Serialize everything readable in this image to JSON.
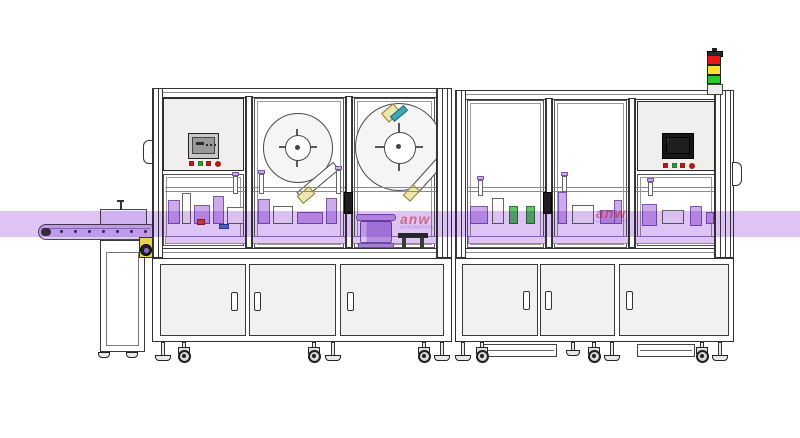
{
  "scene": {
    "watermark": {
      "text_main": "anw",
      "text_sub": "AUTOMATION"
    }
  },
  "colors": {
    "purple_band": "#c9a0ee",
    "machinery_lavender": "#cdaaec",
    "accent_yellow": "#e8d44a",
    "tower_red": "#e81818",
    "tower_yellow": "#ffe02e",
    "tower_green": "#2ec82e",
    "panel_gray": "#f0efee",
    "hmi_screen_left": "#989898",
    "hmi_screen_right": "#1f1f1f",
    "button_red": "#cc1111",
    "button_green": "#22aa22"
  },
  "tower": {
    "lights": [
      "red",
      "yellow",
      "green"
    ]
  },
  "machines": {
    "left_hmi": {
      "buttons": [
        "red",
        "green",
        "red",
        "red-circle"
      ]
    },
    "right_hmi": {
      "buttons": [
        "red",
        "green",
        "red",
        "red-circle"
      ]
    }
  },
  "conveyor": {
    "dot_xs": [
      60,
      74,
      88,
      102,
      116,
      130,
      144
    ],
    "dot_y": 230
  },
  "shapes": {
    "rails": [
      [
        165,
        187,
        272,
        5
      ],
      [
        468,
        187,
        248,
        5
      ]
    ],
    "beds": [
      [
        165,
        236,
        272,
        8
      ],
      [
        468,
        236,
        248,
        8
      ]
    ],
    "stations": [
      [
        168,
        200,
        12,
        24,
        "lav"
      ],
      [
        182,
        193,
        9,
        31,
        "white"
      ],
      [
        194,
        205,
        16,
        19,
        "lav"
      ],
      [
        197,
        219,
        8,
        6,
        "red"
      ],
      [
        213,
        196,
        11,
        28,
        "lav"
      ],
      [
        227,
        207,
        17,
        17,
        "white"
      ],
      [
        219,
        224,
        10,
        5,
        "blue"
      ],
      [
        258,
        199,
        12,
        25,
        "lav"
      ],
      [
        273,
        206,
        20,
        18,
        "white"
      ],
      [
        297,
        212,
        26,
        12,
        "lav"
      ],
      [
        326,
        198,
        11,
        26,
        "lav"
      ],
      [
        470,
        206,
        18,
        18,
        "lav"
      ],
      [
        492,
        198,
        12,
        26,
        "white"
      ],
      [
        509,
        206,
        9,
        18,
        "green"
      ],
      [
        526,
        206,
        9,
        18,
        "green"
      ],
      [
        558,
        192,
        9,
        32,
        "lav"
      ],
      [
        572,
        205,
        22,
        19,
        "white"
      ],
      [
        600,
        210,
        18,
        14,
        "lav"
      ],
      [
        614,
        200,
        8,
        24,
        "lav"
      ],
      [
        642,
        204,
        15,
        22,
        "lav"
      ],
      [
        662,
        210,
        22,
        14,
        "white"
      ],
      [
        690,
        206,
        12,
        20,
        "lav"
      ],
      [
        706,
        212,
        8,
        12,
        "lav"
      ]
    ],
    "cylinders": [
      [
        233,
        176,
        5,
        18
      ],
      [
        259,
        174,
        5,
        20
      ],
      [
        336,
        170,
        5,
        24
      ],
      [
        478,
        180,
        5,
        16
      ],
      [
        562,
        176,
        5,
        16
      ],
      [
        648,
        182,
        5,
        14
      ]
    ],
    "hmi_glyphs": [
      [
        3,
        4,
        8,
        3
      ],
      [
        13,
        6,
        2,
        2
      ],
      [
        17,
        6,
        2,
        2
      ],
      [
        21,
        6,
        2,
        2
      ]
    ]
  },
  "undercarriage": {
    "casters": [
      184,
      314,
      424,
      482,
      594,
      702
    ],
    "feet": [
      163,
      333,
      442,
      463,
      612,
      720
    ],
    "short_feet": [
      573
    ],
    "pedestal_pads": [
      104,
      132
    ]
  }
}
